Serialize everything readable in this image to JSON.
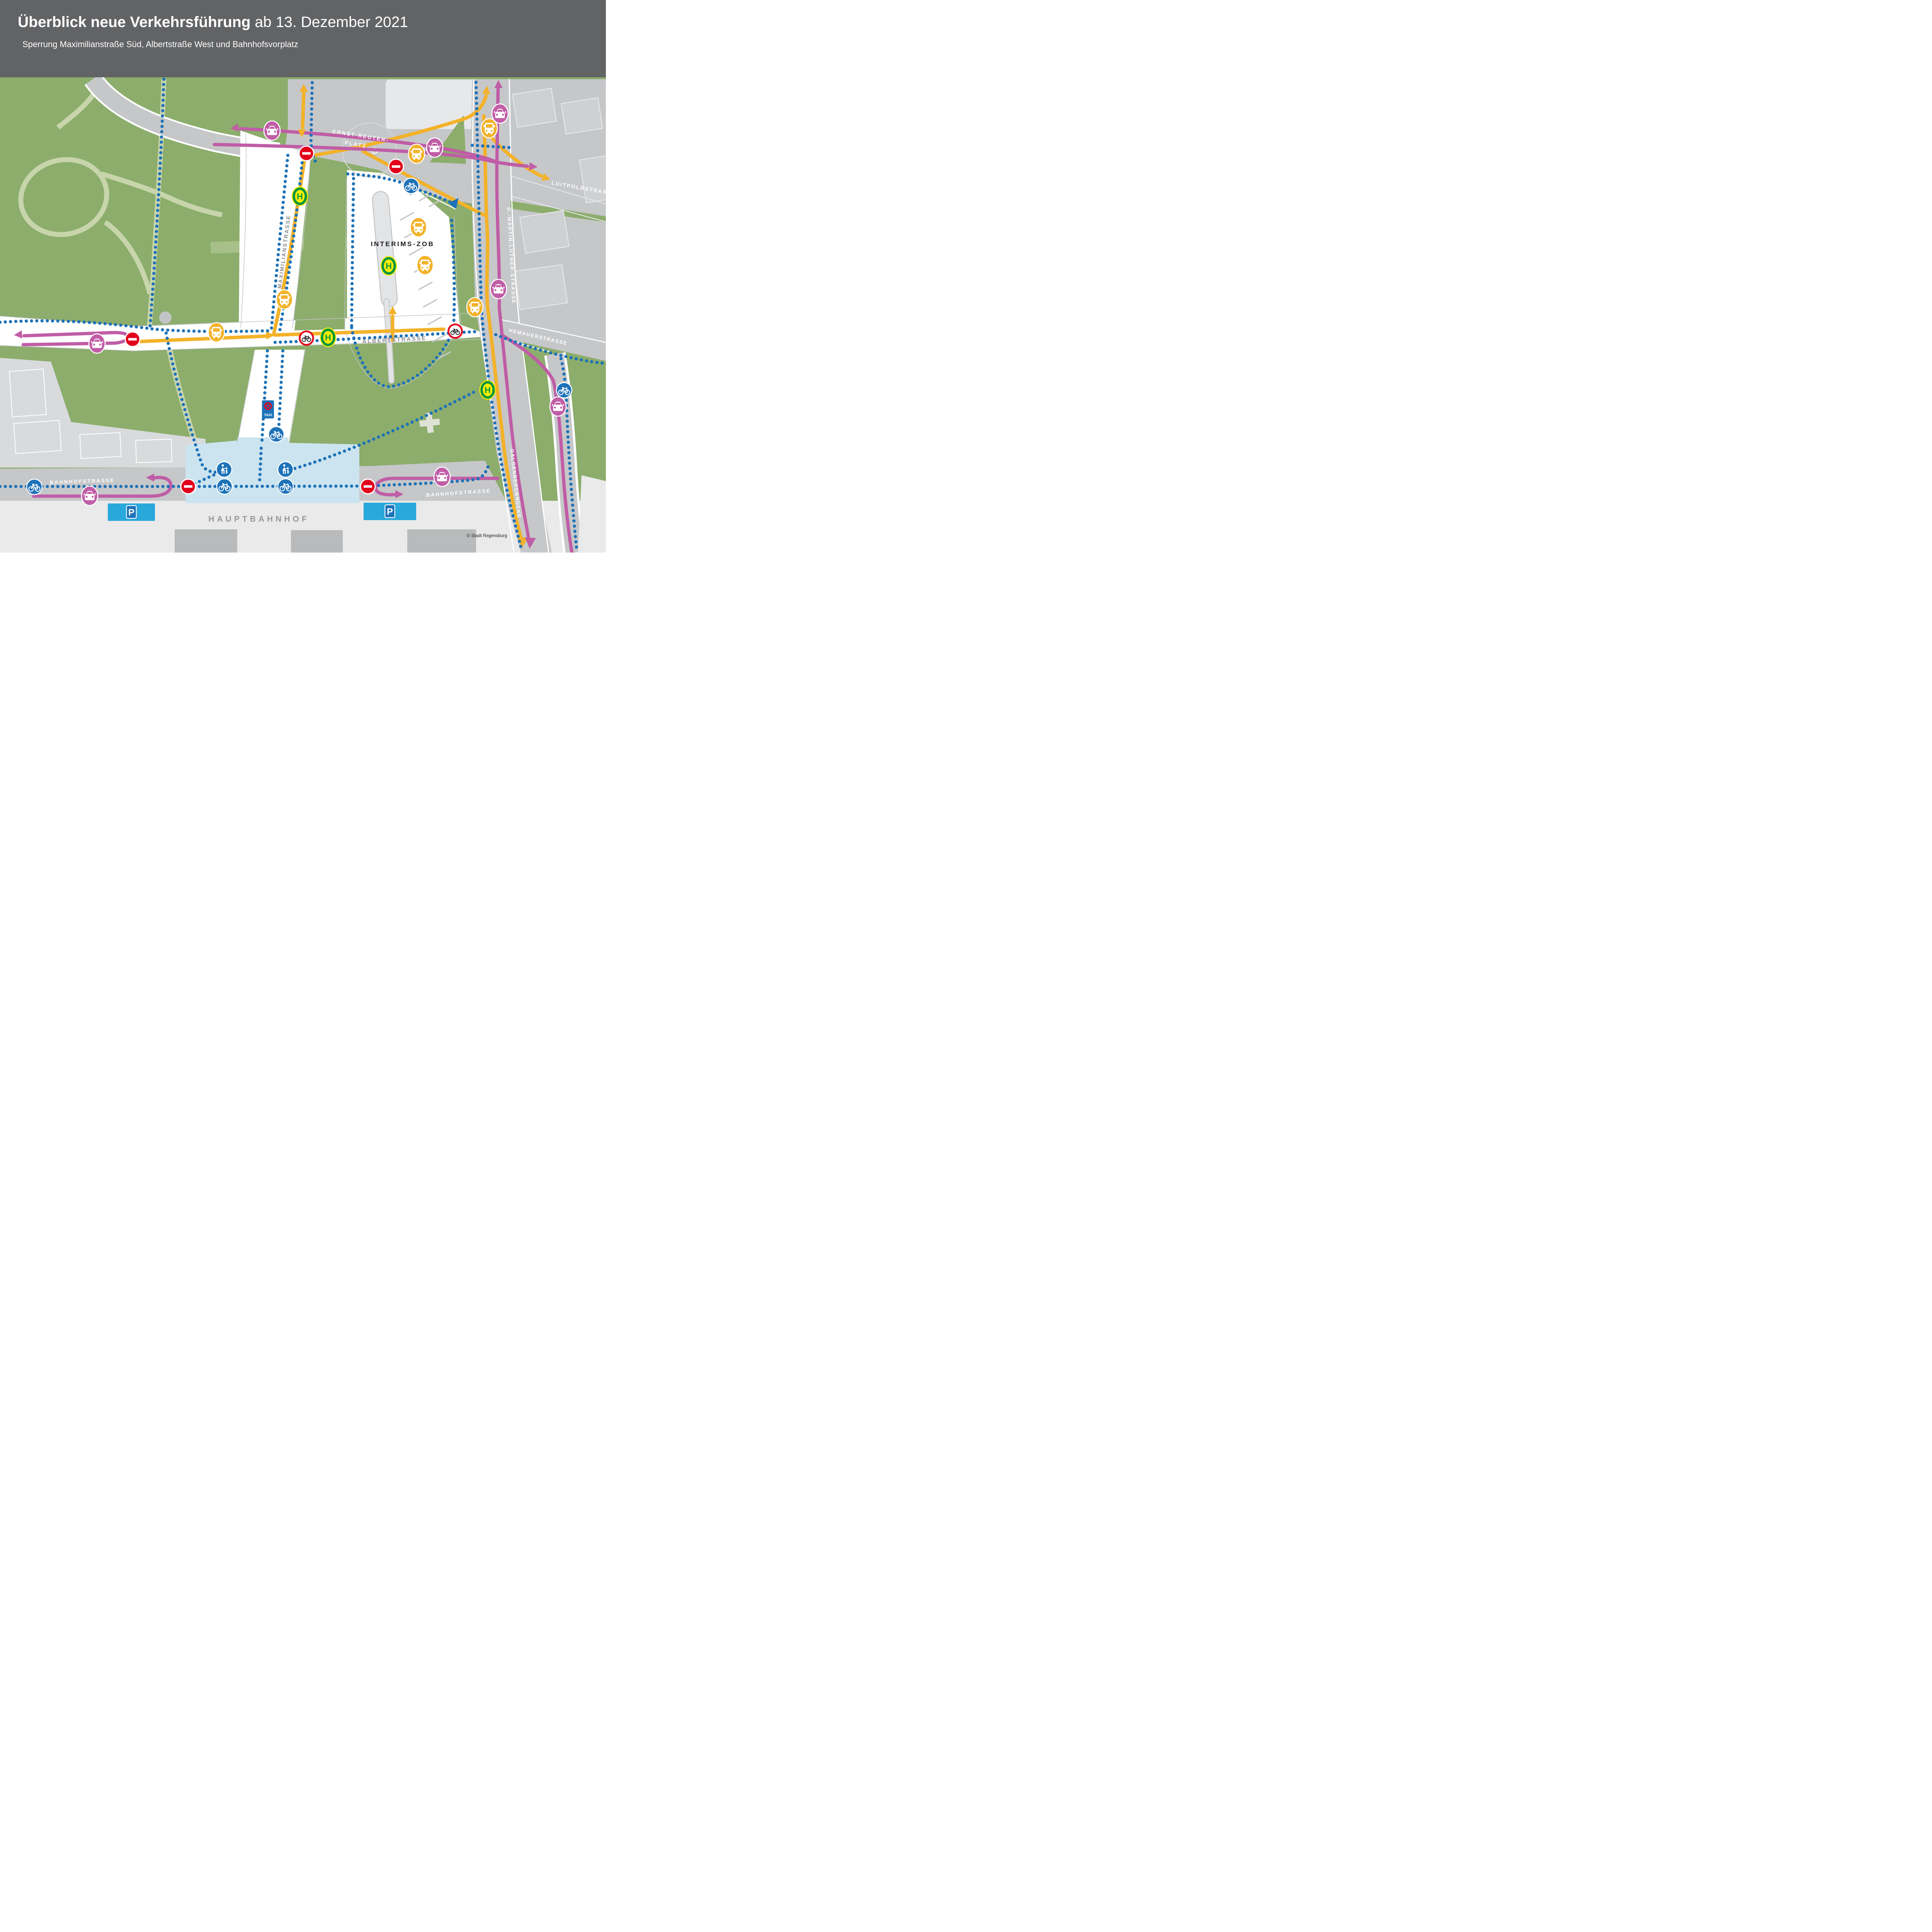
{
  "header": {
    "title_bold": "Überblick neue Verkehrsführung",
    "title_regular": " ab 13. Dezember 2021",
    "subtitle": "Sperrung Maximilianstraße Süd, Albertstraße West und Bahnhofsvorplatz"
  },
  "labels": {
    "ernst_reuter_line1": "ERNST-REUTER-",
    "ernst_reuter_line2": "PLATZ",
    "maximilianstrasse": "MAXIMILIANSTRASSE",
    "albertstrasse": "ALBERTSTRASSE",
    "interims_zob": "INTERIMS-ZOB",
    "d_martin_luther": "D.-MARTIN-LUTHER-STRASSE",
    "luitpoldstrasse": "LUITPOLDSTRASSE",
    "hemauerstrasse": "HEMAUERSTRASSE",
    "galgenbergbruecke": "GALGENBERGBRÜCKE",
    "bahnhofstrasse_west": "BAHNHOFSTRASSE",
    "bahnhofstrasse_east": "BAHNHOFSTRASSE",
    "hauptbahnhof": "HAUPTBAHNHOF"
  },
  "signs": {
    "bus_stop": "H",
    "parking": "P",
    "taxi": "TAXI"
  },
  "credit": "© Stadt Regensburg",
  "icons": {
    "bus_route": "bus-icon (yellow circle)",
    "car_route": "car-icon (magenta circle)",
    "bike_route": "bicycle-icon (blue circle)",
    "pedestrian": "pedestrian-icon (blue circle)",
    "no_entry": "no-entry-icon (red circle, white bar)",
    "no_bike": "no-bicycle-icon (red ring, black bicycle)",
    "bus_stop": "H-stop-icon (green/yellow)",
    "parking": "P-sign (blue on cyan)",
    "taxi_stand": "taxi-no-stopping-sign"
  },
  "colors": {
    "header_bg": "#626365",
    "bus_yellow": "#F3B229",
    "car_magenta": "#C05DA6",
    "bike_blue": "#1D72B8",
    "sign_red": "#E2001A",
    "stop_green": "#009640",
    "stop_yellow": "#FFED00",
    "park_green": "#8CAD6C",
    "road_gray": "#C6C7C9",
    "plaza_blue": "#CBE4EF",
    "parking_cyan": "#29A8DC"
  }
}
